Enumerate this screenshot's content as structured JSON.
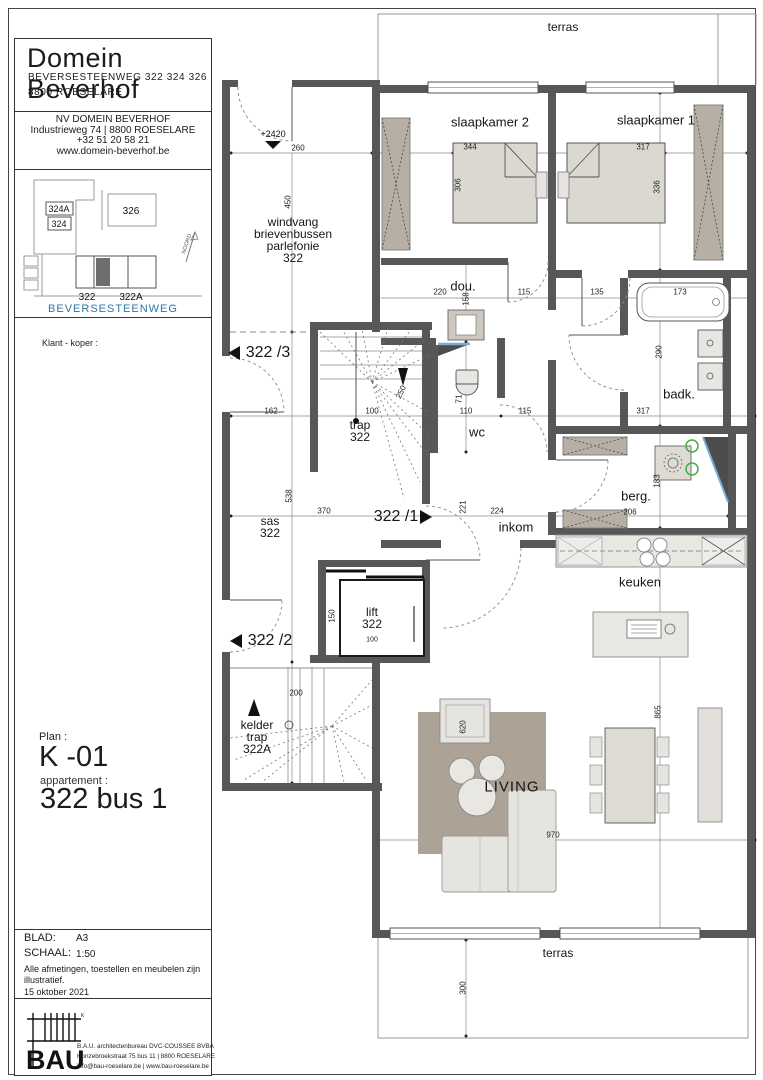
{
  "title_block": {
    "project": {
      "title": "Domein Beverhof",
      "address_line1": "BEVERSESTEENWEG 322 324 326",
      "address_line2": "8800 ROESELARE"
    },
    "developer": {
      "name": "NV DOMEIN BEVERHOF",
      "address": "Industrieweg 74 | 8800 ROESELARE",
      "phone": "+32 51 20 58 21",
      "website": "www.domein-beverhof.be"
    },
    "site_map": {
      "buildings": [
        "324A",
        "324",
        "326",
        "322",
        "322A"
      ],
      "street": "BEVERSESTEENWEG",
      "north": "NOORD",
      "street_color": "#2878aa"
    },
    "client_label": "Klant - koper :",
    "plan_label": "Plan :",
    "plan_code": "K -01",
    "apartment_label": "appartement :",
    "apartment_code": "322 bus 1",
    "sheet_info": {
      "blad_label": "BLAD:",
      "blad_value": "A3",
      "schaal_label": "SCHAAL:",
      "schaal_value": "1:50",
      "note_line1": "Alle afmetingen, toestellen en  meubelen zijn",
      "note_line2": "illustratief.",
      "date": "15 oktober 2021"
    },
    "architect": {
      "logo_text": "BAU",
      "line1": "B.A.U. architectenbureau DVC-COUSSEE BVBA",
      "line2": "Honzebroekstraat 75 bus 11 | 8800 ROESELARE",
      "line3": "info@bau-roeselare.be | www.bau-roeselare.be"
    }
  },
  "plan": {
    "terrace_top": "terras",
    "terrace_bottom": "terras",
    "level_marker": "+2420",
    "rooms": {
      "windvang": [
        "windvang",
        "brievenbussen",
        "parlefonie",
        "322"
      ],
      "slaapkamer2": "slaapkamer 2",
      "slaapkamer1": "slaapkamer 1",
      "dou": "dou.",
      "wc": "wc",
      "badk": "badk.",
      "berg": "berg.",
      "inkom": "inkom",
      "keuken": "keuken",
      "living": "LIVING",
      "trap": [
        "trap",
        "322"
      ],
      "sas": [
        "sas",
        "322"
      ],
      "lift": [
        "lift",
        "322"
      ],
      "lift_dim": "100",
      "kelder": [
        "kelder",
        "trap",
        "322A"
      ]
    },
    "unit_tags": {
      "t3": "322 /3",
      "t1": "322 /1",
      "t2": "322 /2"
    },
    "dims": {
      "windvang_w": "260",
      "windvang_h": "450",
      "bed2_w": "344",
      "bed2_h": "306",
      "bed1_w": "317",
      "bed1_h": "336",
      "dou_w": "220",
      "dou_h": "158",
      "dou_door": "115",
      "sk1_door": "135",
      "wc_w": "110",
      "wc_h": "71",
      "wc_door": "115",
      "tub": "173",
      "badk_h": "290",
      "badk_w": "317",
      "berg_w": "206",
      "berg_h": "183",
      "hall_l": "162",
      "trap_w": "100",
      "trap_r": "250",
      "sas_h": "538",
      "sas_w": "370",
      "lift_h": "150",
      "kelder_w": "200",
      "inkom_h": "221",
      "inkom_w": "224",
      "chair": "620",
      "table_h": "865",
      "living_w": "970",
      "terras_d": "300"
    },
    "colors": {
      "wall": "#575757",
      "wood": "#b7afa4",
      "shaft_blue": "#74aed6",
      "hookup_green": "#3fae3f"
    }
  }
}
